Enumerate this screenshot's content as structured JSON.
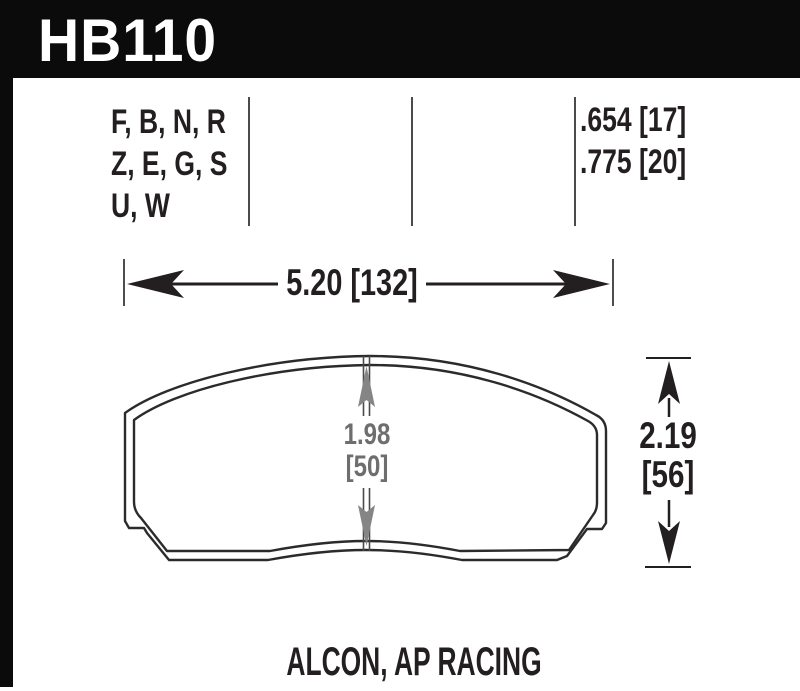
{
  "header": {
    "part_number": "HB110"
  },
  "spec_table": {
    "compound_lines": [
      "F, B, N, R",
      "Z, E, G, S",
      "U, W"
    ],
    "thickness_lines": [
      ".654 [17]",
      ".775 [20]"
    ]
  },
  "dimensions": {
    "width_label": "5.20 [132]",
    "height_value": "2.19",
    "height_bracket": "[56]",
    "center_value": "1.98",
    "center_bracket": "[50]"
  },
  "footer": {
    "applications": "ALCON, AP RACING"
  },
  "colors": {
    "ink": "#231f20",
    "header_bg": "#0b0b0b",
    "dim_gray": "#6e6e6e",
    "arrow_gray": "#858585"
  }
}
